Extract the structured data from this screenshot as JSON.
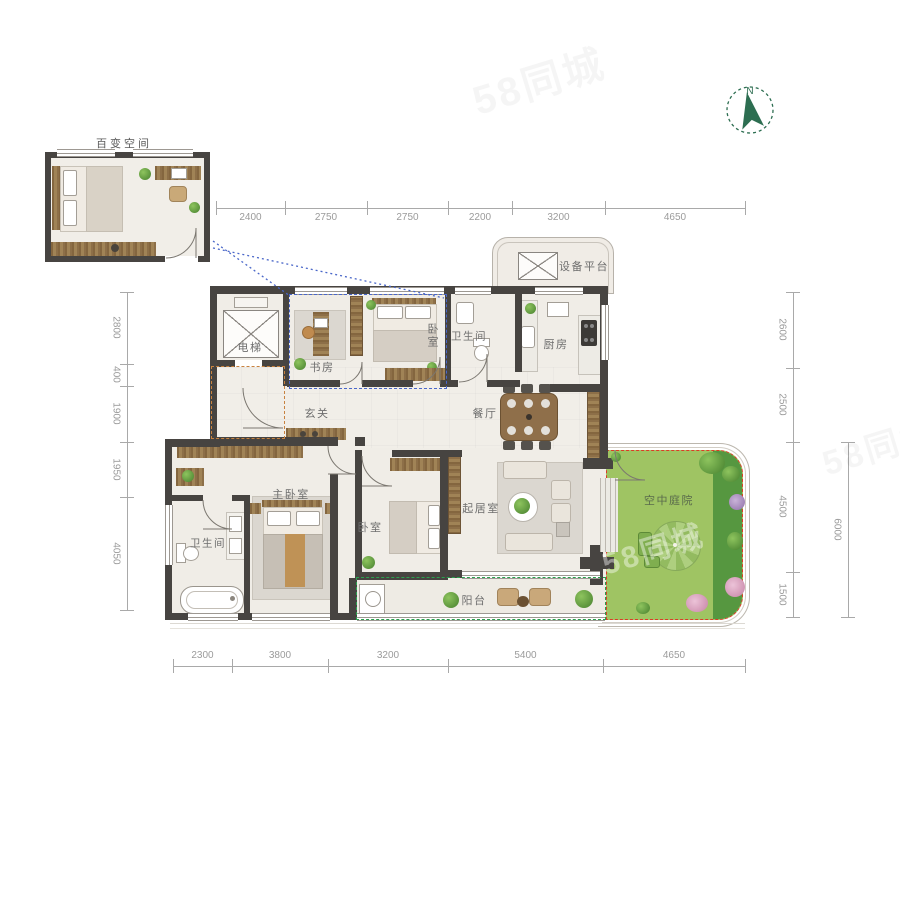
{
  "inset": {
    "label": "百变空间"
  },
  "compass": {
    "label": "N"
  },
  "rooms": {
    "elevator": "电梯",
    "study": "书房",
    "bedroom_top": "卧室",
    "bath_top": "卫生间",
    "kitchen": "厨房",
    "equipment": "设备平台",
    "foyer": "玄关",
    "dining": "餐厅",
    "master_bedroom": "主卧室",
    "master_bath": "卫生间",
    "bedroom_low": "卧室",
    "living": "起居室",
    "courtyard": "空中庭院",
    "balcony": "阳台"
  },
  "dimensions": {
    "top": {
      "orientation": "h",
      "line": 208,
      "label_side": "below",
      "ticks": [
        216,
        285,
        367,
        448,
        512,
        605,
        745
      ],
      "labels": [
        "2400",
        "2750",
        "2750",
        "2200",
        "3200",
        "4650"
      ]
    },
    "bottom": {
      "orientation": "h",
      "line": 666,
      "label_side": "above",
      "ticks": [
        173,
        232,
        328,
        448,
        603,
        745
      ],
      "labels": [
        "2300",
        "3800",
        "3200",
        "5400",
        "4650"
      ]
    },
    "left": {
      "orientation": "v",
      "line": 127,
      "ticks": [
        292,
        364,
        386,
        442,
        497,
        610
      ],
      "labels": [
        "2800",
        "400",
        "1900",
        "1950",
        "4050"
      ]
    },
    "right": {
      "orientation": "v",
      "line": 793,
      "ticks": [
        292,
        368,
        442,
        572,
        617
      ],
      "labels": [
        "2600",
        "2500",
        "4500",
        "1500"
      ]
    },
    "right_outer": {
      "orientation": "v",
      "line": 848,
      "ticks": [
        442,
        617
      ],
      "labels": [
        "6000"
      ]
    }
  },
  "watermark": {
    "text": "58同城"
  },
  "colors": {
    "wall": "#474441",
    "accent_blue": "#4a67c9",
    "accent_orange": "#c8823f",
    "accent_red": "#de3a28",
    "accent_green": "#2aa14e",
    "courtyard_light": "#9fc463",
    "courtyard_dark": "#569740",
    "compass_green": "#2d6e51"
  }
}
